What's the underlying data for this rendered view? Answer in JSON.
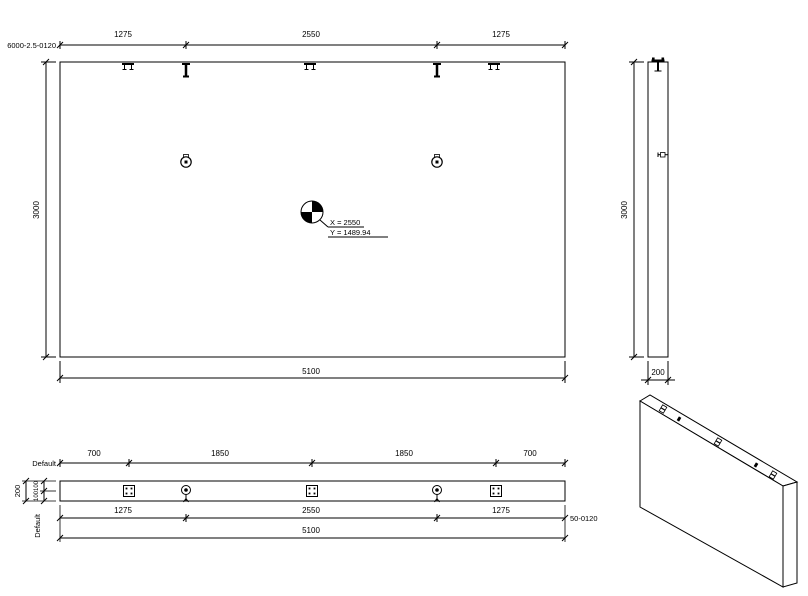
{
  "labels": {
    "element_mark_top_left": "6000-2.5-0120",
    "element_mark_bottom_right": "50-0120",
    "default_top": "Default",
    "default_side": "Default"
  },
  "front_view": {
    "dims_top": [
      "1275",
      "2550",
      "1275"
    ],
    "dim_height": "3000",
    "dim_width": "5100",
    "cog_x": "X = 2550",
    "cog_y": "Y = 1489.94"
  },
  "side_view": {
    "dim_height": "3000",
    "dim_thickness": "200"
  },
  "plan_view": {
    "dims_top": [
      "700",
      "1850",
      "1850",
      "700"
    ],
    "dims_mid": [
      "1275",
      "2550",
      "1275"
    ],
    "dim_total": "5100",
    "dim_thickness": "200",
    "dims_thickness_halves": [
      "100",
      "100"
    ]
  },
  "icons": {
    "cog_icon": "quartered center-of-gravity circle",
    "lifting_pin_icon": "T-pin lifting anchor",
    "hook_anchor_icon": "double-staple anchor",
    "face_socket_icon": "circular face socket",
    "plate_anchor_icon": "square plate with four pins"
  },
  "colors": {
    "line": "#000000",
    "background": "#ffffff"
  }
}
